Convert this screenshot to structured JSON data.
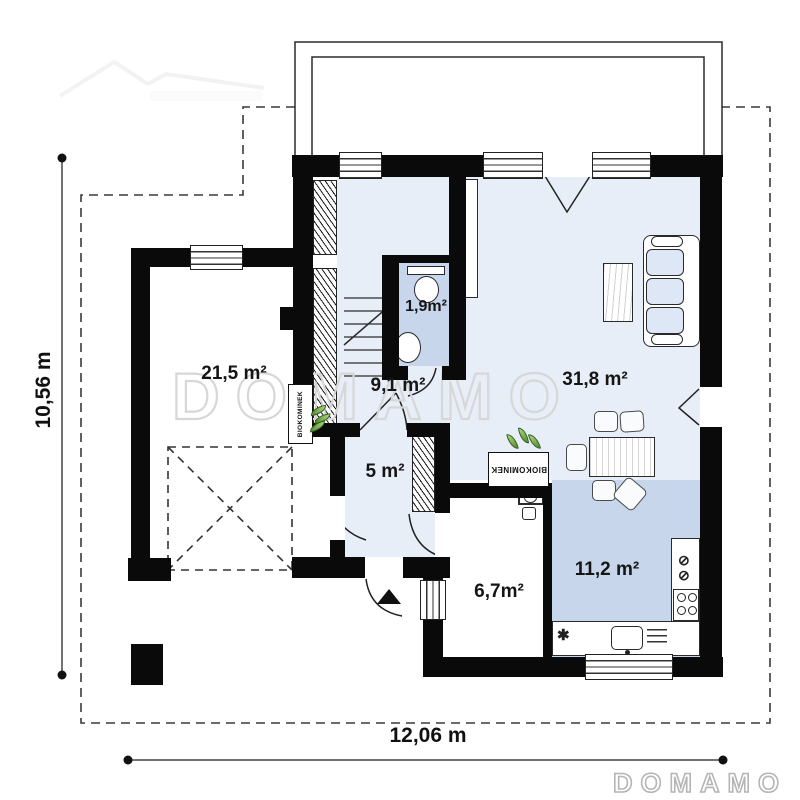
{
  "watermark": {
    "text": "DOMAMO"
  },
  "brand": {
    "logo_text": "DOMAMO"
  },
  "dimensions": {
    "height_label": "10,56 m",
    "width_label": "12,06 m"
  },
  "rooms": {
    "garage": "21,5 m²",
    "hall": "9,1 m²",
    "bathroom": "1,9m²",
    "living_room": "31,8 m²",
    "entry": "5 m²",
    "utility": "6,7m²",
    "kitchen": "11,2 m²"
  },
  "fixtures": {
    "bio_fireplace": "BIOKOMINEK"
  },
  "icons": {
    "hob_crossed_circle": "⊘",
    "counter_star": "✱"
  },
  "colors": {
    "wall": "#0a0a0a",
    "room_light": "#e8eef8",
    "room_medium": "#c8d6ec",
    "watermark_stroke": "#d7d7d7"
  }
}
